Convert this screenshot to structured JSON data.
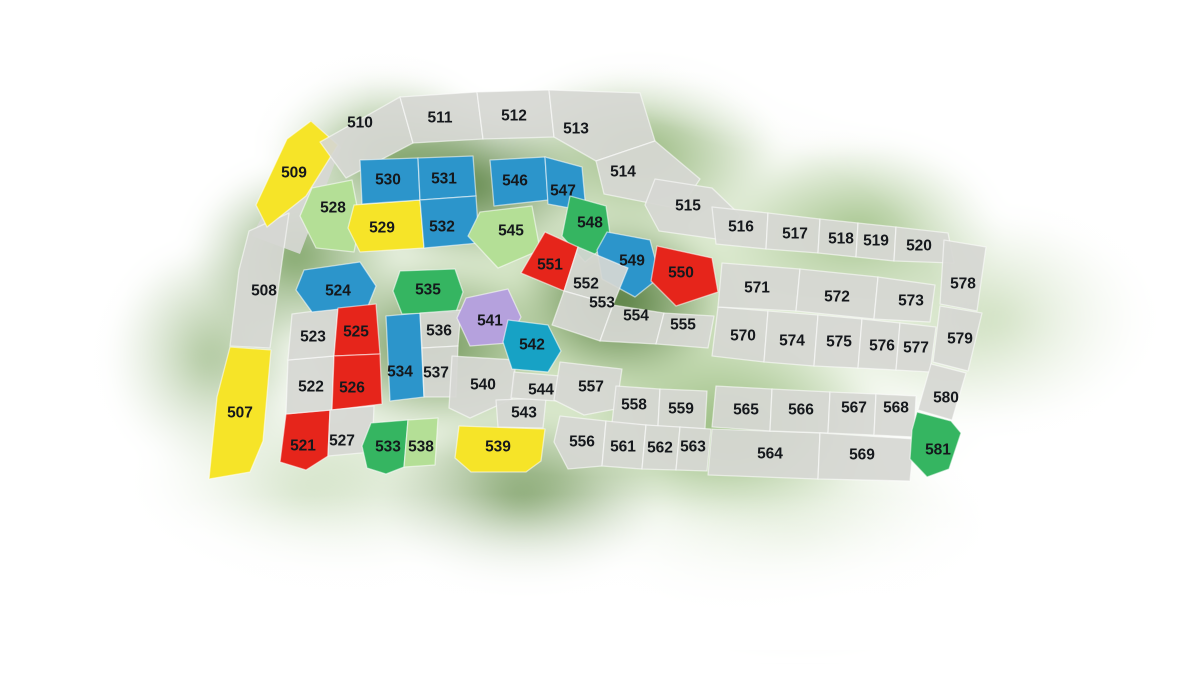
{
  "map": {
    "kind": "subdivision-lot-map",
    "colors": {
      "gray": "rgba(214,215,211,0.93)",
      "yellow": "#f6e428",
      "blue": "#2c95cb",
      "teal": "#17a2c5",
      "lightgreen": "#b4df96",
      "green": "#35b561",
      "red": "#e6251b",
      "purple": "#b5a1dd"
    },
    "underlays": [
      {
        "name": "road-strip",
        "c": "gray",
        "pts": "252,236 311,120 341,147 300,254"
      }
    ],
    "parcels": [
      {
        "lot": "507",
        "c": "yellow",
        "pts": "230,347 271,350 263,441 250,472 209,479 217,397",
        "lx": 240,
        "ly": 412
      },
      {
        "lot": "508",
        "c": "gray",
        "pts": "249,231 289,213 282,262 270,348 230,346 239,270",
        "lx": 264,
        "ly": 290
      },
      {
        "lot": "509",
        "c": "yellow",
        "pts": "311,121 338,145 306,196 267,227 256,205 287,139",
        "lx": 294,
        "ly": 172
      },
      {
        "lot": "510",
        "c": "gray",
        "pts": "320,142 400,97 413,143 346,178",
        "lx": 360,
        "ly": 122
      },
      {
        "lot": "511",
        "c": "gray",
        "pts": "400,97 477,92 483,139 413,143",
        "lx": 440,
        "ly": 117
      },
      {
        "lot": "512",
        "c": "gray",
        "pts": "477,92 549,90 554,137 483,139",
        "lx": 514,
        "ly": 115
      },
      {
        "lot": "513",
        "c": "gray",
        "pts": "549,90 640,93 655,141 596,161 554,137",
        "lx": 576,
        "ly": 128
      },
      {
        "lot": "514",
        "c": "gray",
        "pts": "596,161 655,141 700,179 680,209 604,194",
        "lx": 623,
        "ly": 171
      },
      {
        "lot": "515",
        "c": "gray",
        "pts": "655,179 712,188 740,215 731,241 659,231 645,205",
        "lx": 688,
        "ly": 205
      },
      {
        "lot": "516",
        "c": "gray",
        "pts": "712,207 768,213 766,249 716,244",
        "lx": 741,
        "ly": 226
      },
      {
        "lot": "517",
        "c": "gray",
        "pts": "768,213 820,219 818,253 766,249",
        "lx": 795,
        "ly": 233
      },
      {
        "lot": "518",
        "c": "gray",
        "pts": "820,219 858,223 856,257 818,253",
        "lx": 841,
        "ly": 238
      },
      {
        "lot": "519",
        "c": "gray",
        "pts": "858,223 896,227 894,261 856,257",
        "lx": 876,
        "ly": 240
      },
      {
        "lot": "520",
        "c": "gray",
        "pts": "896,227 948,233 954,263 894,261",
        "lx": 919,
        "ly": 245
      },
      {
        "lot": "521",
        "c": "red",
        "pts": "286,414 330,410 328,456 306,470 280,462",
        "lx": 303,
        "ly": 445
      },
      {
        "lot": "522",
        "c": "gray",
        "pts": "288,360 334,356 332,410 286,414",
        "lx": 311,
        "ly": 386
      },
      {
        "lot": "523",
        "c": "gray",
        "pts": "292,314 338,308 334,356 288,360",
        "lx": 313,
        "ly": 336
      },
      {
        "lot": "524",
        "c": "blue",
        "pts": "304,270 360,262 376,286 368,306 312,312 296,290",
        "lx": 338,
        "ly": 290
      },
      {
        "lot": "525",
        "c": "red",
        "pts": "338,308 376,304 380,354 334,356",
        "lx": 356,
        "ly": 331
      },
      {
        "lot": "526",
        "c": "red",
        "pts": "334,356 380,354 382,404 332,410",
        "lx": 352,
        "ly": 387
      },
      {
        "lot": "527",
        "c": "gray",
        "pts": "330,410 374,406 372,452 328,456",
        "lx": 342,
        "ly": 440
      },
      {
        "lot": "528",
        "c": "lightgreen",
        "pts": "312,188 352,180 360,222 354,252 316,248 300,216",
        "lx": 333,
        "ly": 207
      },
      {
        "lot": "529",
        "c": "yellow",
        "pts": "354,205 420,200 424,248 360,252 348,228",
        "lx": 382,
        "ly": 227
      },
      {
        "lot": "530",
        "c": "blue",
        "pts": "360,160 418,158 420,200 362,204",
        "lx": 388,
        "ly": 179
      },
      {
        "lot": "531",
        "c": "blue",
        "pts": "418,158 473,156 476,196 420,200",
        "lx": 444,
        "ly": 178
      },
      {
        "lot": "532",
        "c": "blue",
        "pts": "420,200 476,196 479,243 424,248",
        "lx": 442,
        "ly": 226
      },
      {
        "lot": "533",
        "c": "green",
        "pts": "371,423 408,420 404,467 386,474 367,468 362,446",
        "lx": 388,
        "ly": 446
      },
      {
        "lot": "534",
        "c": "blue",
        "pts": "386,316 420,313 424,397 390,401",
        "lx": 400,
        "ly": 371
      },
      {
        "lot": "535",
        "c": "green",
        "pts": "400,271 455,269 463,292 456,312 402,314 393,291",
        "lx": 428,
        "ly": 289
      },
      {
        "lot": "536",
        "c": "gray",
        "pts": "420,313 461,310 458,346 422,348",
        "lx": 439,
        "ly": 330
      },
      {
        "lot": "537",
        "c": "gray",
        "pts": "422,348 458,346 456,397 424,397",
        "lx": 436,
        "ly": 372
      },
      {
        "lot": "538",
        "c": "lightgreen",
        "pts": "408,420 438,418 435,465 404,467",
        "lx": 421,
        "ly": 446
      },
      {
        "lot": "539",
        "c": "yellow",
        "pts": "459,426 545,429 541,461 526,472 471,472 455,458",
        "lx": 498,
        "ly": 446
      },
      {
        "lot": "540",
        "c": "gray",
        "pts": "452,356 516,360 512,399 470,418 449,408",
        "lx": 483,
        "ly": 384
      },
      {
        "lot": "541",
        "c": "purple",
        "pts": "466,298 508,289 521,317 508,343 470,346 457,318",
        "lx": 490,
        "ly": 320
      },
      {
        "lot": "542",
        "c": "teal",
        "pts": "508,320 548,325 561,351 548,372 512,369 503,342",
        "lx": 532,
        "ly": 344
      },
      {
        "lot": "543",
        "c": "gray",
        "pts": "496,400 546,398 543,428 498,427",
        "lx": 524,
        "ly": 412
      },
      {
        "lot": "544",
        "c": "gray",
        "pts": "514,372 560,376 557,401 511,398",
        "lx": 541,
        "ly": 389
      },
      {
        "lot": "545",
        "c": "lightgreen",
        "pts": "480,212 532,206 540,250 498,268 468,236",
        "lx": 511,
        "ly": 230
      },
      {
        "lot": "546",
        "c": "blue",
        "pts": "490,160 545,157 548,200 494,206",
        "lx": 515,
        "ly": 180
      },
      {
        "lot": "547",
        "c": "blue",
        "pts": "545,157 582,167 586,211 548,204",
        "lx": 563,
        "ly": 190
      },
      {
        "lot": "548",
        "c": "green",
        "pts": "570,196 606,206 611,241 585,262 562,236",
        "lx": 590,
        "ly": 222
      },
      {
        "lot": "549",
        "c": "blue",
        "pts": "607,232 650,240 660,277 635,297 602,279 597,250",
        "lx": 632,
        "ly": 260
      },
      {
        "lot": "550",
        "c": "red",
        "pts": "657,246 712,258 718,292 676,306 651,281",
        "lx": 681,
        "ly": 272
      },
      {
        "lot": "551",
        "c": "red",
        "pts": "545,232 578,247 564,291 521,273",
        "lx": 550,
        "ly": 264
      },
      {
        "lot": "552",
        "c": "gray",
        "pts": "578,247 628,268 613,305 564,291",
        "lx": 586,
        "ly": 283
      },
      {
        "lot": "553",
        "c": "gray",
        "pts": "564,291 613,305 600,341 552,325",
        "lx": 602,
        "ly": 302
      },
      {
        "lot": "554",
        "c": "gray",
        "pts": "613,305 664,313 656,344 600,341",
        "lx": 636,
        "ly": 315
      },
      {
        "lot": "555",
        "c": "gray",
        "pts": "664,313 714,316 708,348 656,344",
        "lx": 683,
        "ly": 324
      },
      {
        "lot": "556",
        "c": "gray",
        "pts": "560,416 606,421 602,466 568,469 554,442",
        "lx": 582,
        "ly": 441
      },
      {
        "lot": "557",
        "c": "gray",
        "pts": "560,362 622,369 616,409 584,415 554,400",
        "lx": 591,
        "ly": 386
      },
      {
        "lot": "558",
        "c": "gray",
        "pts": "616,386 660,389 658,426 612,423",
        "lx": 634,
        "ly": 404
      },
      {
        "lot": "559",
        "c": "gray",
        "pts": "660,389 707,391 705,429 658,426",
        "lx": 681,
        "ly": 408
      },
      {
        "lot": "561",
        "c": "gray",
        "pts": "606,421 646,425 642,469 602,466",
        "lx": 623,
        "ly": 446
      },
      {
        "lot": "562",
        "c": "gray",
        "pts": "646,425 680,427 676,470 642,469",
        "lx": 660,
        "ly": 447
      },
      {
        "lot": "563",
        "c": "gray",
        "pts": "680,427 711,429 707,471 676,470",
        "lx": 693,
        "ly": 446
      },
      {
        "lot": "564",
        "c": "gray",
        "pts": "712,429 820,433 818,479 708,475",
        "lx": 770,
        "ly": 453
      },
      {
        "lot": "565",
        "c": "gray",
        "pts": "716,386 772,389 770,431 712,427",
        "lx": 746,
        "ly": 409
      },
      {
        "lot": "566",
        "c": "gray",
        "pts": "772,389 830,392 828,433 770,431",
        "lx": 801,
        "ly": 409
      },
      {
        "lot": "567",
        "c": "gray",
        "pts": "830,392 876,394 874,435 828,433",
        "lx": 854,
        "ly": 407
      },
      {
        "lot": "568",
        "c": "gray",
        "pts": "876,394 916,396 914,437 874,435",
        "lx": 896,
        "ly": 407
      },
      {
        "lot": "569",
        "c": "gray",
        "pts": "820,433 914,439 910,481 818,479",
        "lx": 862,
        "ly": 454
      },
      {
        "lot": "570",
        "c": "gray",
        "pts": "718,307 768,311 764,362 712,356",
        "lx": 743,
        "ly": 335
      },
      {
        "lot": "571",
        "c": "gray",
        "pts": "722,263 800,269 796,311 718,307",
        "lx": 757,
        "ly": 287
      },
      {
        "lot": "572",
        "c": "gray",
        "pts": "800,269 878,277 874,319 796,311",
        "lx": 837,
        "ly": 296
      },
      {
        "lot": "573",
        "c": "gray",
        "pts": "878,277 935,285 930,322 874,319",
        "lx": 911,
        "ly": 300
      },
      {
        "lot": "574",
        "c": "gray",
        "pts": "768,311 818,315 814,366 764,362",
        "lx": 792,
        "ly": 340
      },
      {
        "lot": "575",
        "c": "gray",
        "pts": "818,315 862,319 858,368 814,366",
        "lx": 839,
        "ly": 341
      },
      {
        "lot": "576",
        "c": "gray",
        "pts": "862,319 900,323 896,370 858,368",
        "lx": 882,
        "ly": 345
      },
      {
        "lot": "577",
        "c": "gray",
        "pts": "900,323 936,327 930,372 896,370",
        "lx": 916,
        "ly": 347
      },
      {
        "lot": "578",
        "c": "gray",
        "pts": "944,240 986,247 977,311 940,304",
        "lx": 963,
        "ly": 283
      },
      {
        "lot": "579",
        "c": "gray",
        "pts": "940,306 982,313 968,371 933,362",
        "lx": 960,
        "ly": 338
      },
      {
        "lot": "580",
        "c": "gray",
        "pts": "931,364 966,373 952,420 918,410",
        "lx": 946,
        "ly": 397
      },
      {
        "lot": "581",
        "c": "green",
        "pts": "917,412 951,421 961,433 949,469 927,477 910,459 912,430",
        "lx": 938,
        "ly": 449
      }
    ]
  }
}
